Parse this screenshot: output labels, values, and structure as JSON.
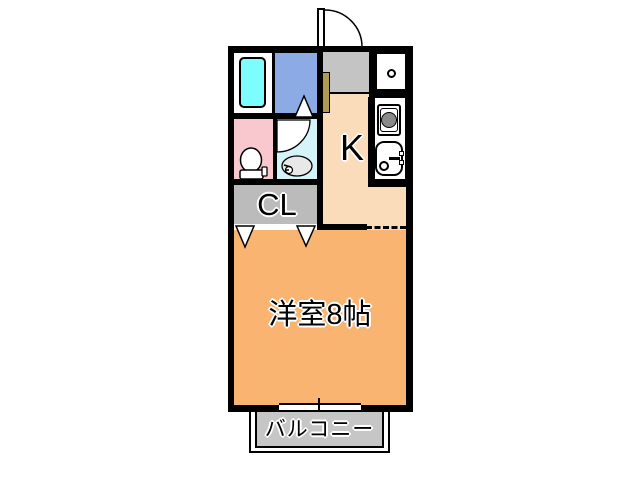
{
  "title": "apartment-floor-plan",
  "rooms": {
    "kitchen": {
      "label": "K",
      "floor_color": "#FBDCBA"
    },
    "closet": {
      "label": "CL",
      "floor_color": "#BBBBBB"
    },
    "main_room": {
      "label": "洋室8帖",
      "floor_color": "#F8B470"
    },
    "balcony": {
      "label": "バルコニー",
      "floor_color": "#C6C6C6"
    },
    "toilet": {
      "floor_color": "#F9C8CE"
    },
    "washroom": {
      "floor_color": "#D4F4F9"
    },
    "bath": {
      "floor_color": "#FFFFFF",
      "tub_color": "#7DFDFF"
    },
    "utility_room": {
      "floor_color": "#8CAAE4"
    },
    "entry": {
      "floor_color": "#C4C4C4",
      "shoe_cabinet_color": "#AE9C52"
    }
  },
  "fixtures": {
    "entrance_door": "hinged-door-swing",
    "bathtub": "bathtub",
    "toilet": "toilet-with-tank",
    "vanity_sink": "oval-sink",
    "stove": "single-burner-stove",
    "kitchen_sink": "sink-with-faucet",
    "water_heater": "small-circle-fixture",
    "closet_doors": "folding-door-triangles",
    "window": "sliding-window"
  },
  "wall_color": "#000000"
}
